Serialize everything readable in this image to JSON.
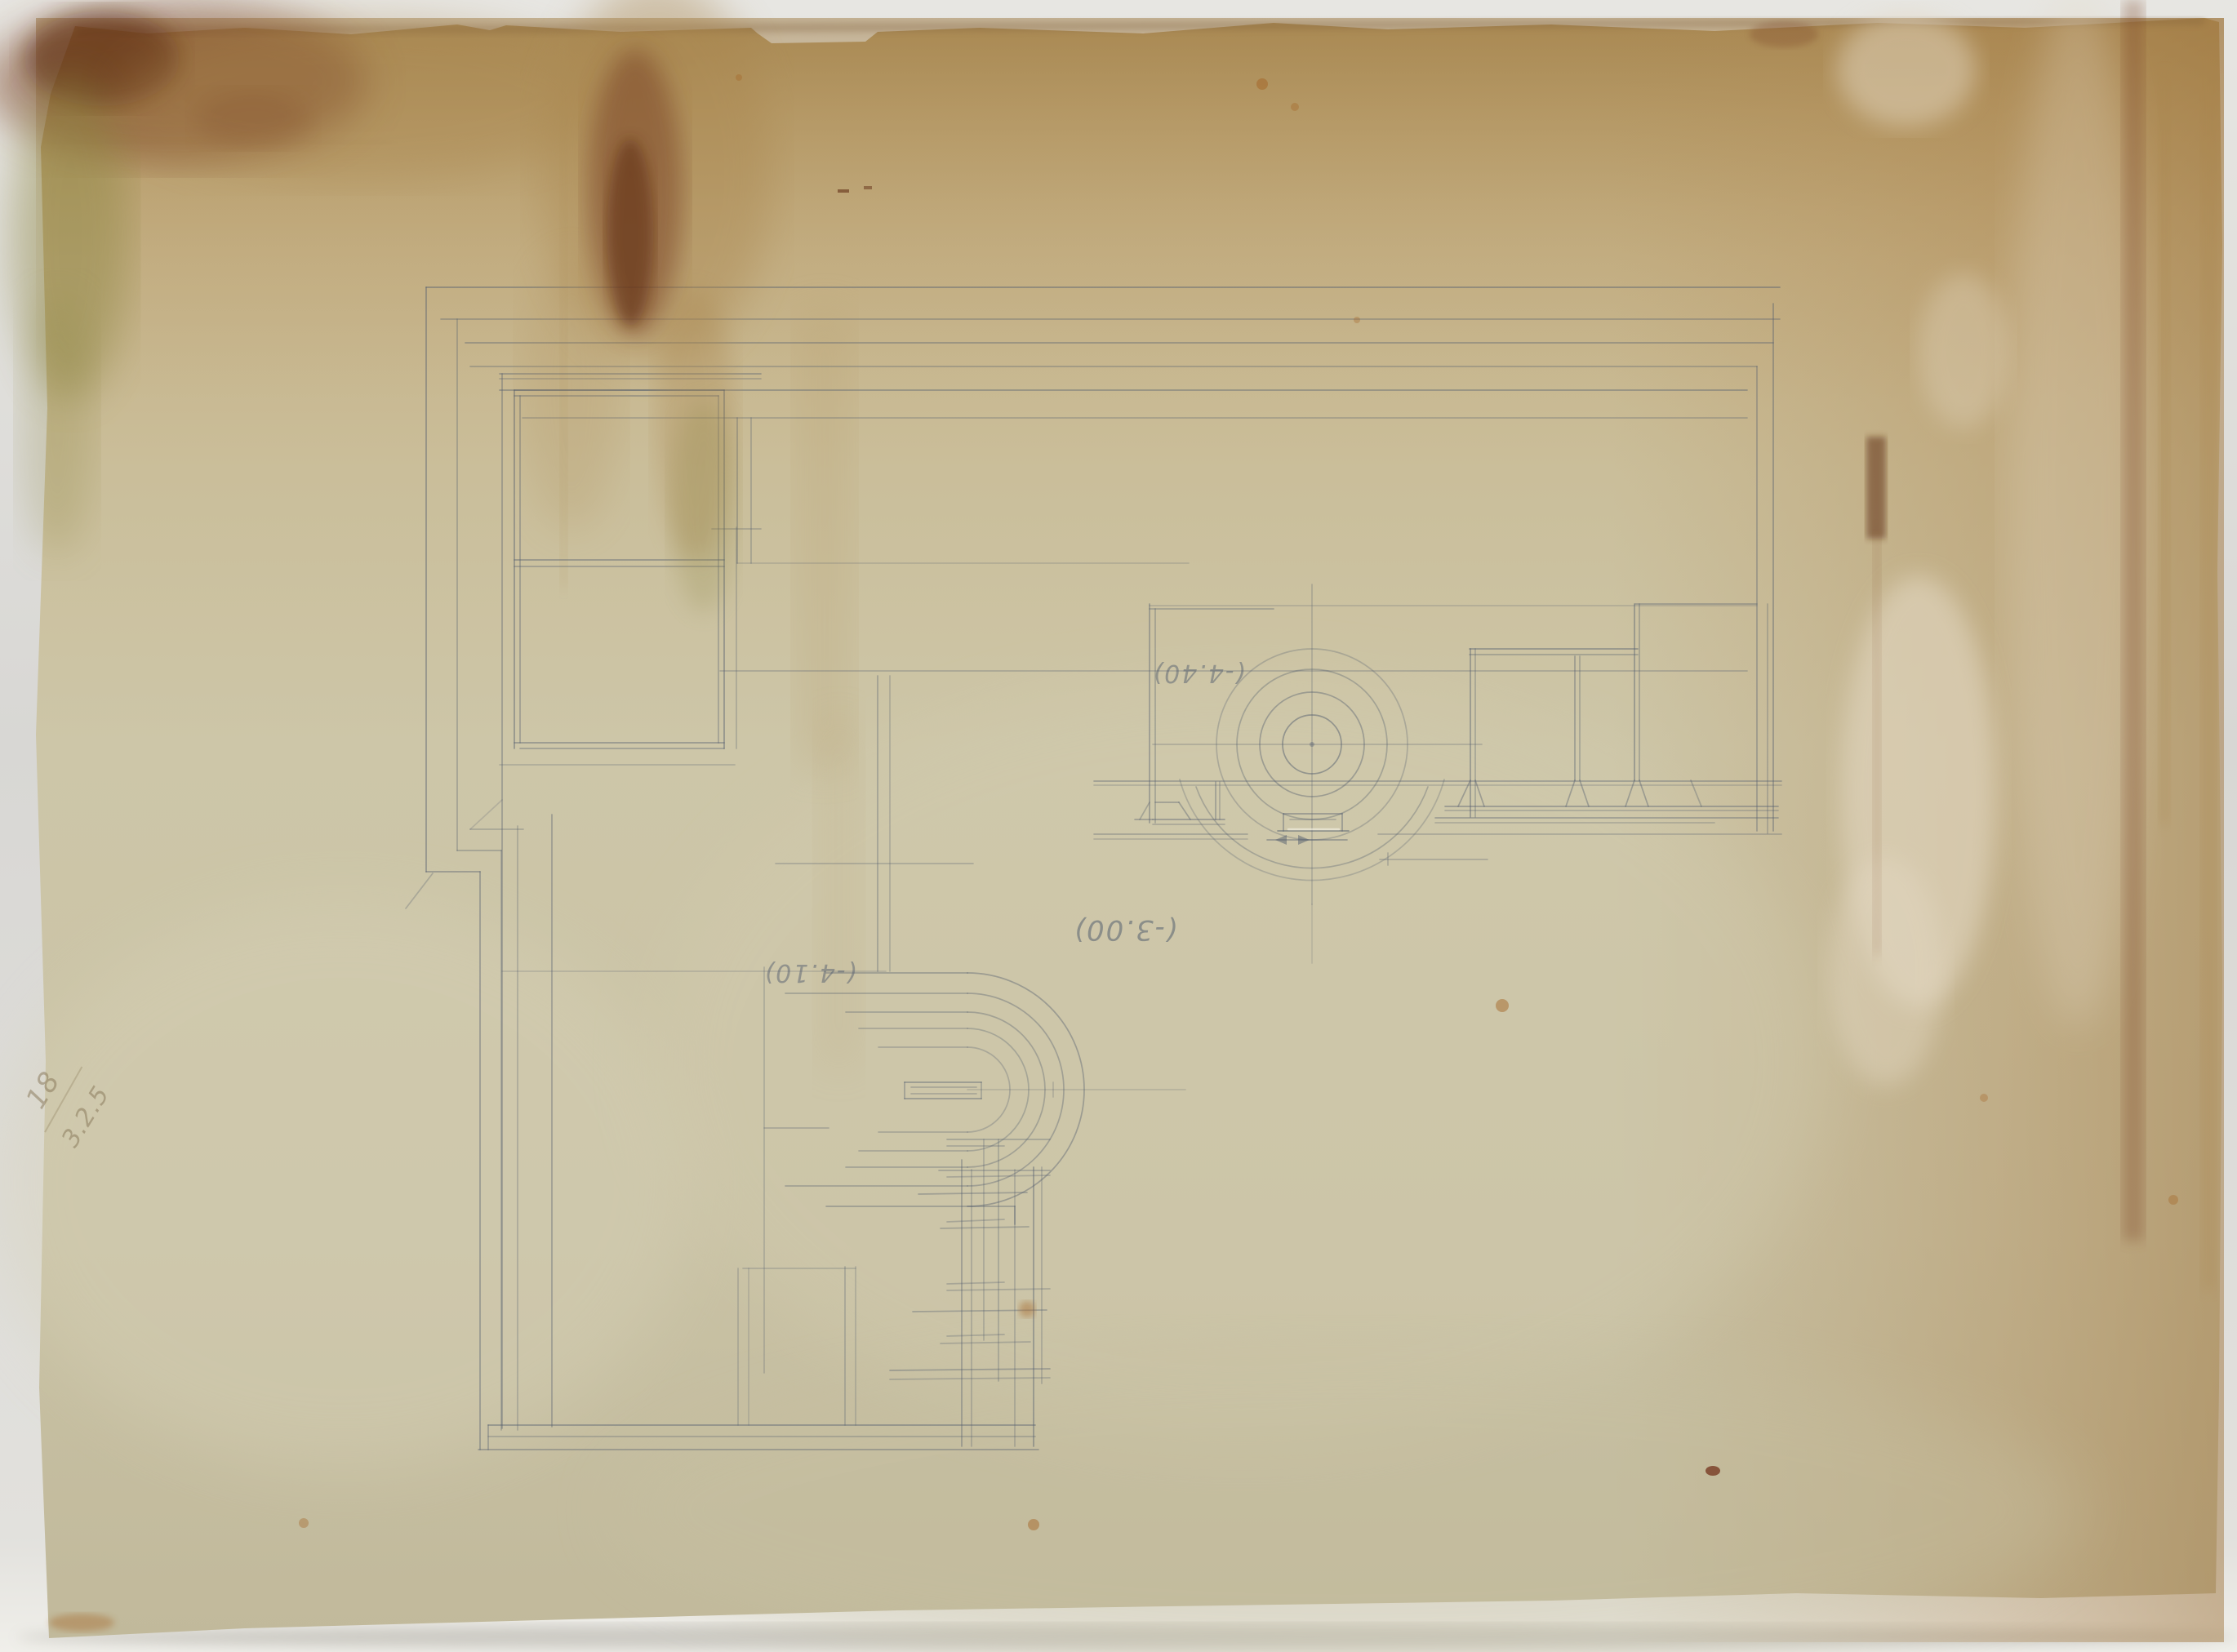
{
  "annotations": {
    "rotunda_level": "(-4.40)",
    "apse_level": "(-3.00)",
    "ramp_level": "(-4.10)",
    "corner_mark_upper": "18",
    "corner_mark_lower": "3.2.5"
  },
  "colors": {
    "backdrop_gray": "#d8d7d3",
    "paper_base": "#cbc3a6",
    "paper_top_tan": "#b4975f",
    "pencil": "#566070",
    "stain_red_brown": "#7c4526",
    "stain_dark_core": "#59250f",
    "stain_olive": "#8b8440",
    "stain_warm_halo": "#a9854e",
    "efflorescence_white": "#e3d8c2",
    "rust_spot": "#a5682a",
    "dark_red_spot": "#6e2a12",
    "corner_ink": "#857455"
  }
}
